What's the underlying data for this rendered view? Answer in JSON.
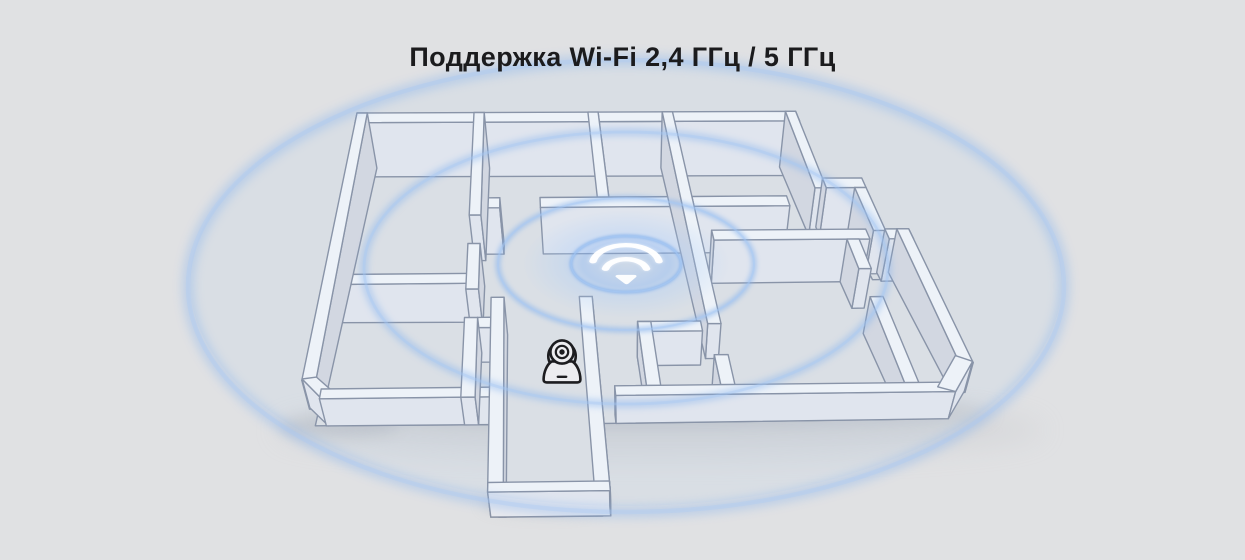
{
  "title": "Поддержка Wi-Fi 2,4 ГГц / 5 ГГц",
  "colors": {
    "bg": "#e0e1e3",
    "line": "#8a92a3",
    "wall_top": "#f6f7f9",
    "wall_face_front": "#e8e9ee",
    "wall_face_side": "#d9dae0",
    "floor": "#e1e2e5",
    "shadow": "#b3b5bb",
    "ring": "#85b2ee",
    "ring_bright": "#a8c9f4",
    "ink": "#1d1d20",
    "icon_white": "#ffffff",
    "title_ink": "#1b1b1d"
  },
  "diagram": {
    "canvas": {
      "w": 1245,
      "h": 560
    },
    "projection": {
      "top_left": [
        357,
        113
      ],
      "top_right": [
        870,
        111
      ],
      "bottom_left": [
        298,
        399
      ],
      "bottom_right": [
        1012,
        391
      ],
      "vanish": [
        628,
        1600
      ],
      "wall_height": [
        56,
        28
      ]
    },
    "floor_outline": [
      [
        0.01,
        0.012
      ],
      [
        0.845,
        0.012
      ],
      [
        0.845,
        0.255
      ],
      [
        0.915,
        0.255
      ],
      [
        0.915,
        0.437
      ],
      [
        0.955,
        0.437
      ],
      [
        0.955,
        0.885
      ],
      [
        0.91,
        0.988
      ],
      [
        0.415,
        0.988
      ],
      [
        0.415,
        1.325
      ],
      [
        0.278,
        1.325
      ],
      [
        0.278,
        0.988
      ],
      [
        0.012,
        0.988
      ]
    ],
    "walls": [
      {
        "n": "outer-north-wall",
        "r": [
          0,
          0,
          0.855,
          0.034
        ]
      },
      {
        "n": "outer-west-wall",
        "r": [
          0,
          0,
          0.02,
          0.935
        ]
      },
      {
        "n": "outer-sw-bevel",
        "p": [
          [
            0.0,
            0.93
          ],
          [
            0.02,
            0.924
          ],
          [
            0.052,
            0.985
          ],
          [
            0.033,
            1.0
          ]
        ],
        "f": [
          [
            3,
            0
          ]
        ]
      },
      {
        "n": "outer-south-wall-left",
        "r": [
          0.03,
          0.966,
          0.288,
          1.0
        ]
      },
      {
        "n": "outer-south-wall-right",
        "r": [
          0.445,
          0.966,
          0.921,
          1.0
        ]
      },
      {
        "n": "outer-east-wall-upper",
        "r": [
          0.835,
          0,
          0.855,
          0.272
        ]
      },
      {
        "n": "outer-step-wall",
        "r": [
          0.855,
          0.238,
          0.925,
          0.272
        ]
      },
      {
        "n": "outer-east-wall-mid",
        "r": [
          0.905,
          0.272,
          0.925,
          0.425
        ]
      },
      {
        "n": "outer-east-wall-lower",
        "r": [
          0.945,
          0.42,
          0.965,
          0.898
        ]
      },
      {
        "n": "outer-se-bevel",
        "p": [
          [
            0.944,
            0.872
          ],
          [
            0.965,
            0.893
          ],
          [
            0.921,
            1.0
          ],
          [
            0.899,
            0.982
          ]
        ],
        "f": [
          [
            1,
            2
          ]
        ]
      },
      {
        "n": "left-room-wall-a",
        "r": [
          0.228,
          0,
          0.248,
          0.36
        ]
      },
      {
        "n": "left-room-wall-b",
        "r": [
          0.228,
          0.46,
          0.248,
          0.62
        ]
      },
      {
        "n": "left-room-wall-c",
        "r": [
          0.228,
          0.72,
          0.248,
          1.0
        ]
      },
      {
        "n": "left-rooms-divider",
        "r": [
          0.02,
          0.565,
          0.248,
          0.6
        ]
      },
      {
        "n": "top-rooms-divider",
        "r": [
          0.45,
          0,
          0.47,
          0.3
        ]
      },
      {
        "n": "hall-north-wall-stub",
        "r": [
          0.248,
          0.3,
          0.28,
          0.335
        ]
      },
      {
        "n": "hall-north-wall",
        "r": [
          0.35,
          0.3,
          0.615,
          0.335
        ]
      },
      {
        "n": "center-wall-upper",
        "r": [
          0.595,
          0,
          0.615,
          0.75
        ]
      },
      {
        "n": "center-wall-lower",
        "r": [
          0.595,
          0.86,
          0.615,
          0.966
        ]
      },
      {
        "n": "right-room-south-wall",
        "r": [
          0.615,
          0.3,
          0.78,
          0.335
        ]
      },
      {
        "n": "right-mid-wall",
        "r": [
          0.635,
          0.42,
          0.893,
          0.455
        ]
      },
      {
        "n": "right-mid-wall-b",
        "r": [
          0.925,
          0.42,
          0.965,
          0.455
        ]
      },
      {
        "n": "pantry-west-wall-a",
        "r": [
          0.855,
          0.455,
          0.875,
          0.56
        ]
      },
      {
        "n": "pantry-west-wall-b",
        "r": [
          0.855,
          0.66,
          0.875,
          0.966
        ]
      },
      {
        "n": "bath-wall-h",
        "r": [
          0.49,
          0.74,
          0.585,
          0.775
        ]
      },
      {
        "n": "bath-wall-v",
        "r": [
          0.49,
          0.74,
          0.51,
          0.966
        ]
      },
      {
        "n": "corridor-link-wall",
        "r": [
          0.248,
          0.72,
          0.268,
          0.756
        ]
      },
      {
        "n": "corridor-west-wall",
        "r": [
          0.268,
          0.65,
          0.288,
          1.335
        ]
      },
      {
        "n": "corridor-east-wall",
        "r": [
          0.405,
          0.65,
          0.425,
          1.335
        ]
      },
      {
        "n": "corridor-end-wall",
        "r": [
          0.268,
          1.301,
          0.425,
          1.335
        ]
      }
    ],
    "shadows": [
      {
        "cx": 655,
        "cy": 413,
        "rx": 335,
        "ry": 15,
        "blur": 9,
        "op": 0.5
      },
      {
        "cx": 545,
        "cy": 503,
        "rx": 62,
        "ry": 11,
        "blur": 7,
        "op": 0.5
      },
      {
        "cx": 340,
        "cy": 426,
        "rx": 60,
        "ry": 11,
        "blur": 7,
        "op": 0.45
      },
      {
        "cx": 660,
        "cy": 430,
        "rx": 385,
        "ry": 28,
        "blur": 14,
        "op": 0.22
      }
    ],
    "ambient_tint": {
      "cx": 626,
      "cy": 282,
      "rx": 436,
      "ry": 224,
      "opacity": 0.07
    },
    "glow": {
      "cx": 626,
      "cy": 264,
      "rx": 104,
      "ry": 54
    },
    "rings": [
      {
        "cx": 626,
        "cy": 264,
        "rx": 55,
        "ry": 28,
        "sw": 3,
        "blur": 1.2,
        "op": 0.8
      },
      {
        "cx": 626,
        "cy": 264,
        "rx": 128,
        "ry": 66,
        "sw": 5,
        "blur": 2.5,
        "op": 0.6
      },
      {
        "cx": 626,
        "cy": 268,
        "rx": 262,
        "ry": 136,
        "sw": 7,
        "blur": 3.5,
        "op": 0.5
      },
      {
        "cx": 626,
        "cy": 286,
        "rx": 438,
        "ry": 226,
        "sw": 11,
        "blur": 5,
        "op": 0.42
      }
    ],
    "wifi_icon": {
      "name": "wifi-signal-icon",
      "cx": 626,
      "cy": 267
    },
    "camera_icon": {
      "name": "security-camera-icon",
      "cx": 562,
      "cy": 356
    }
  }
}
